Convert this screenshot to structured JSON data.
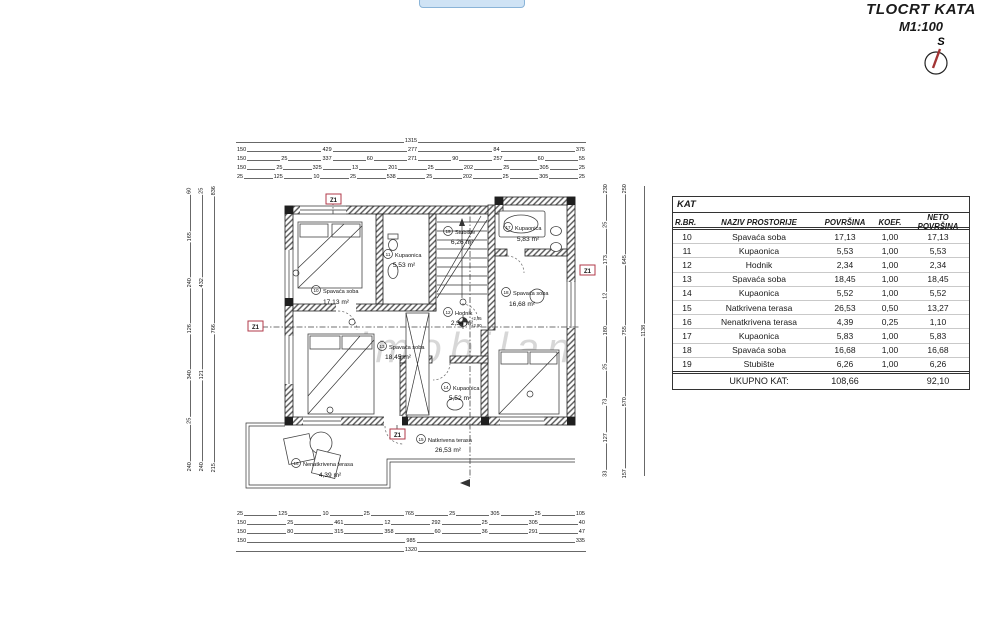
{
  "page": {
    "title": "TLOCRT KATA",
    "scale": "M1:100",
    "compass_label": "S",
    "watermark": "imobilan"
  },
  "table": {
    "title": "KAT",
    "headers": [
      "R.BR.",
      "NAZIV PROSTORIJE",
      "POVRŠINA",
      "KOEF.",
      "NETO POVRŠINA"
    ],
    "rows": [
      [
        "10",
        "Spavaća soba",
        "17,13",
        "1,00",
        "17,13"
      ],
      [
        "11",
        "Kupaonica",
        "5,53",
        "1,00",
        "5,53"
      ],
      [
        "12",
        "Hodnik",
        "2,34",
        "1,00",
        "2,34"
      ],
      [
        "13",
        "Spavaća soba",
        "18,45",
        "1,00",
        "18,45"
      ],
      [
        "14",
        "Kupaonica",
        "5,52",
        "1,00",
        "5,52"
      ],
      [
        "15",
        "Natkrivena terasa",
        "26,53",
        "0,50",
        "13,27"
      ],
      [
        "16",
        "Nenatkrivena terasa",
        "4,39",
        "0,25",
        "1,10"
      ],
      [
        "17",
        "Kupaonica",
        "5,83",
        "1,00",
        "5,83"
      ],
      [
        "18",
        "Spavaća soba",
        "16,68",
        "1,00",
        "16,68"
      ],
      [
        "19",
        "Stubište",
        "6,26",
        "1,00",
        "6,26"
      ]
    ],
    "footer": {
      "label": "UKUPNO KAT:",
      "povrsina": "108,66",
      "neto": "92,10"
    }
  },
  "rooms": [
    {
      "num": "10",
      "name": "Spavaća soba",
      "area": "17,13 m²"
    },
    {
      "num": "11",
      "name": "Kupaonica",
      "area": "5,53 m²"
    },
    {
      "num": "12",
      "name": "Hodnik",
      "area": "2,34 m²"
    },
    {
      "num": "13",
      "name": "Spavaća soba",
      "area": "18,45 m²"
    },
    {
      "num": "14",
      "name": "Kupaonica",
      "area": "5,52 m²"
    },
    {
      "num": "15",
      "name": "Natkrivena terasa",
      "area": "26,53 m²"
    },
    {
      "num": "16",
      "name": "Nenatkrivena terasa",
      "area": "4,39 m²"
    },
    {
      "num": "17",
      "name": "Kupaonica",
      "area": "5,83 m²"
    },
    {
      "num": "18",
      "name": "Spavaća soba",
      "area": "16,68 m²"
    },
    {
      "num": "19",
      "name": "Stubište",
      "area": "6,26 m²"
    }
  ],
  "plan": {
    "section_marker": "Z1",
    "elevation_upper": "+2,95",
    "elevation_lower": "+2,90",
    "dims": {
      "top": [
        [
          "1315"
        ],
        [
          "150",
          "429",
          "277",
          "84",
          "375"
        ],
        [
          "150",
          "25",
          "337",
          "60",
          "271",
          "90",
          "257",
          "60",
          "55"
        ],
        [
          "150",
          "25",
          "325",
          "13",
          "201",
          "25",
          "202",
          "25",
          "305",
          "25"
        ],
        [
          "25",
          "125",
          "10",
          "25",
          "538",
          "25",
          "202",
          "25",
          "305",
          "25"
        ]
      ],
      "bottom": [
        [
          "25",
          "125",
          "10",
          "25",
          "765",
          "25",
          "305",
          "25",
          "105"
        ],
        [
          "150",
          "25",
          "461",
          "12",
          "292",
          "25",
          "305",
          "40"
        ],
        [
          "150",
          "80",
          "315",
          "358",
          "60",
          "36",
          "291",
          "47"
        ],
        [
          "150",
          "985",
          "335"
        ],
        [
          "1320"
        ]
      ],
      "left": [
        [
          "60",
          "165",
          "240",
          "126",
          "340",
          "25",
          "240"
        ],
        [
          "25",
          "432",
          "121",
          "240"
        ],
        [
          "836",
          "766",
          "215"
        ]
      ],
      "right": [
        [
          "230",
          "25",
          "173",
          "12",
          "180",
          "25",
          "73",
          "127",
          "33"
        ],
        [
          "250",
          "645",
          "755",
          "570",
          "157"
        ],
        [
          "1138"
        ]
      ]
    }
  }
}
